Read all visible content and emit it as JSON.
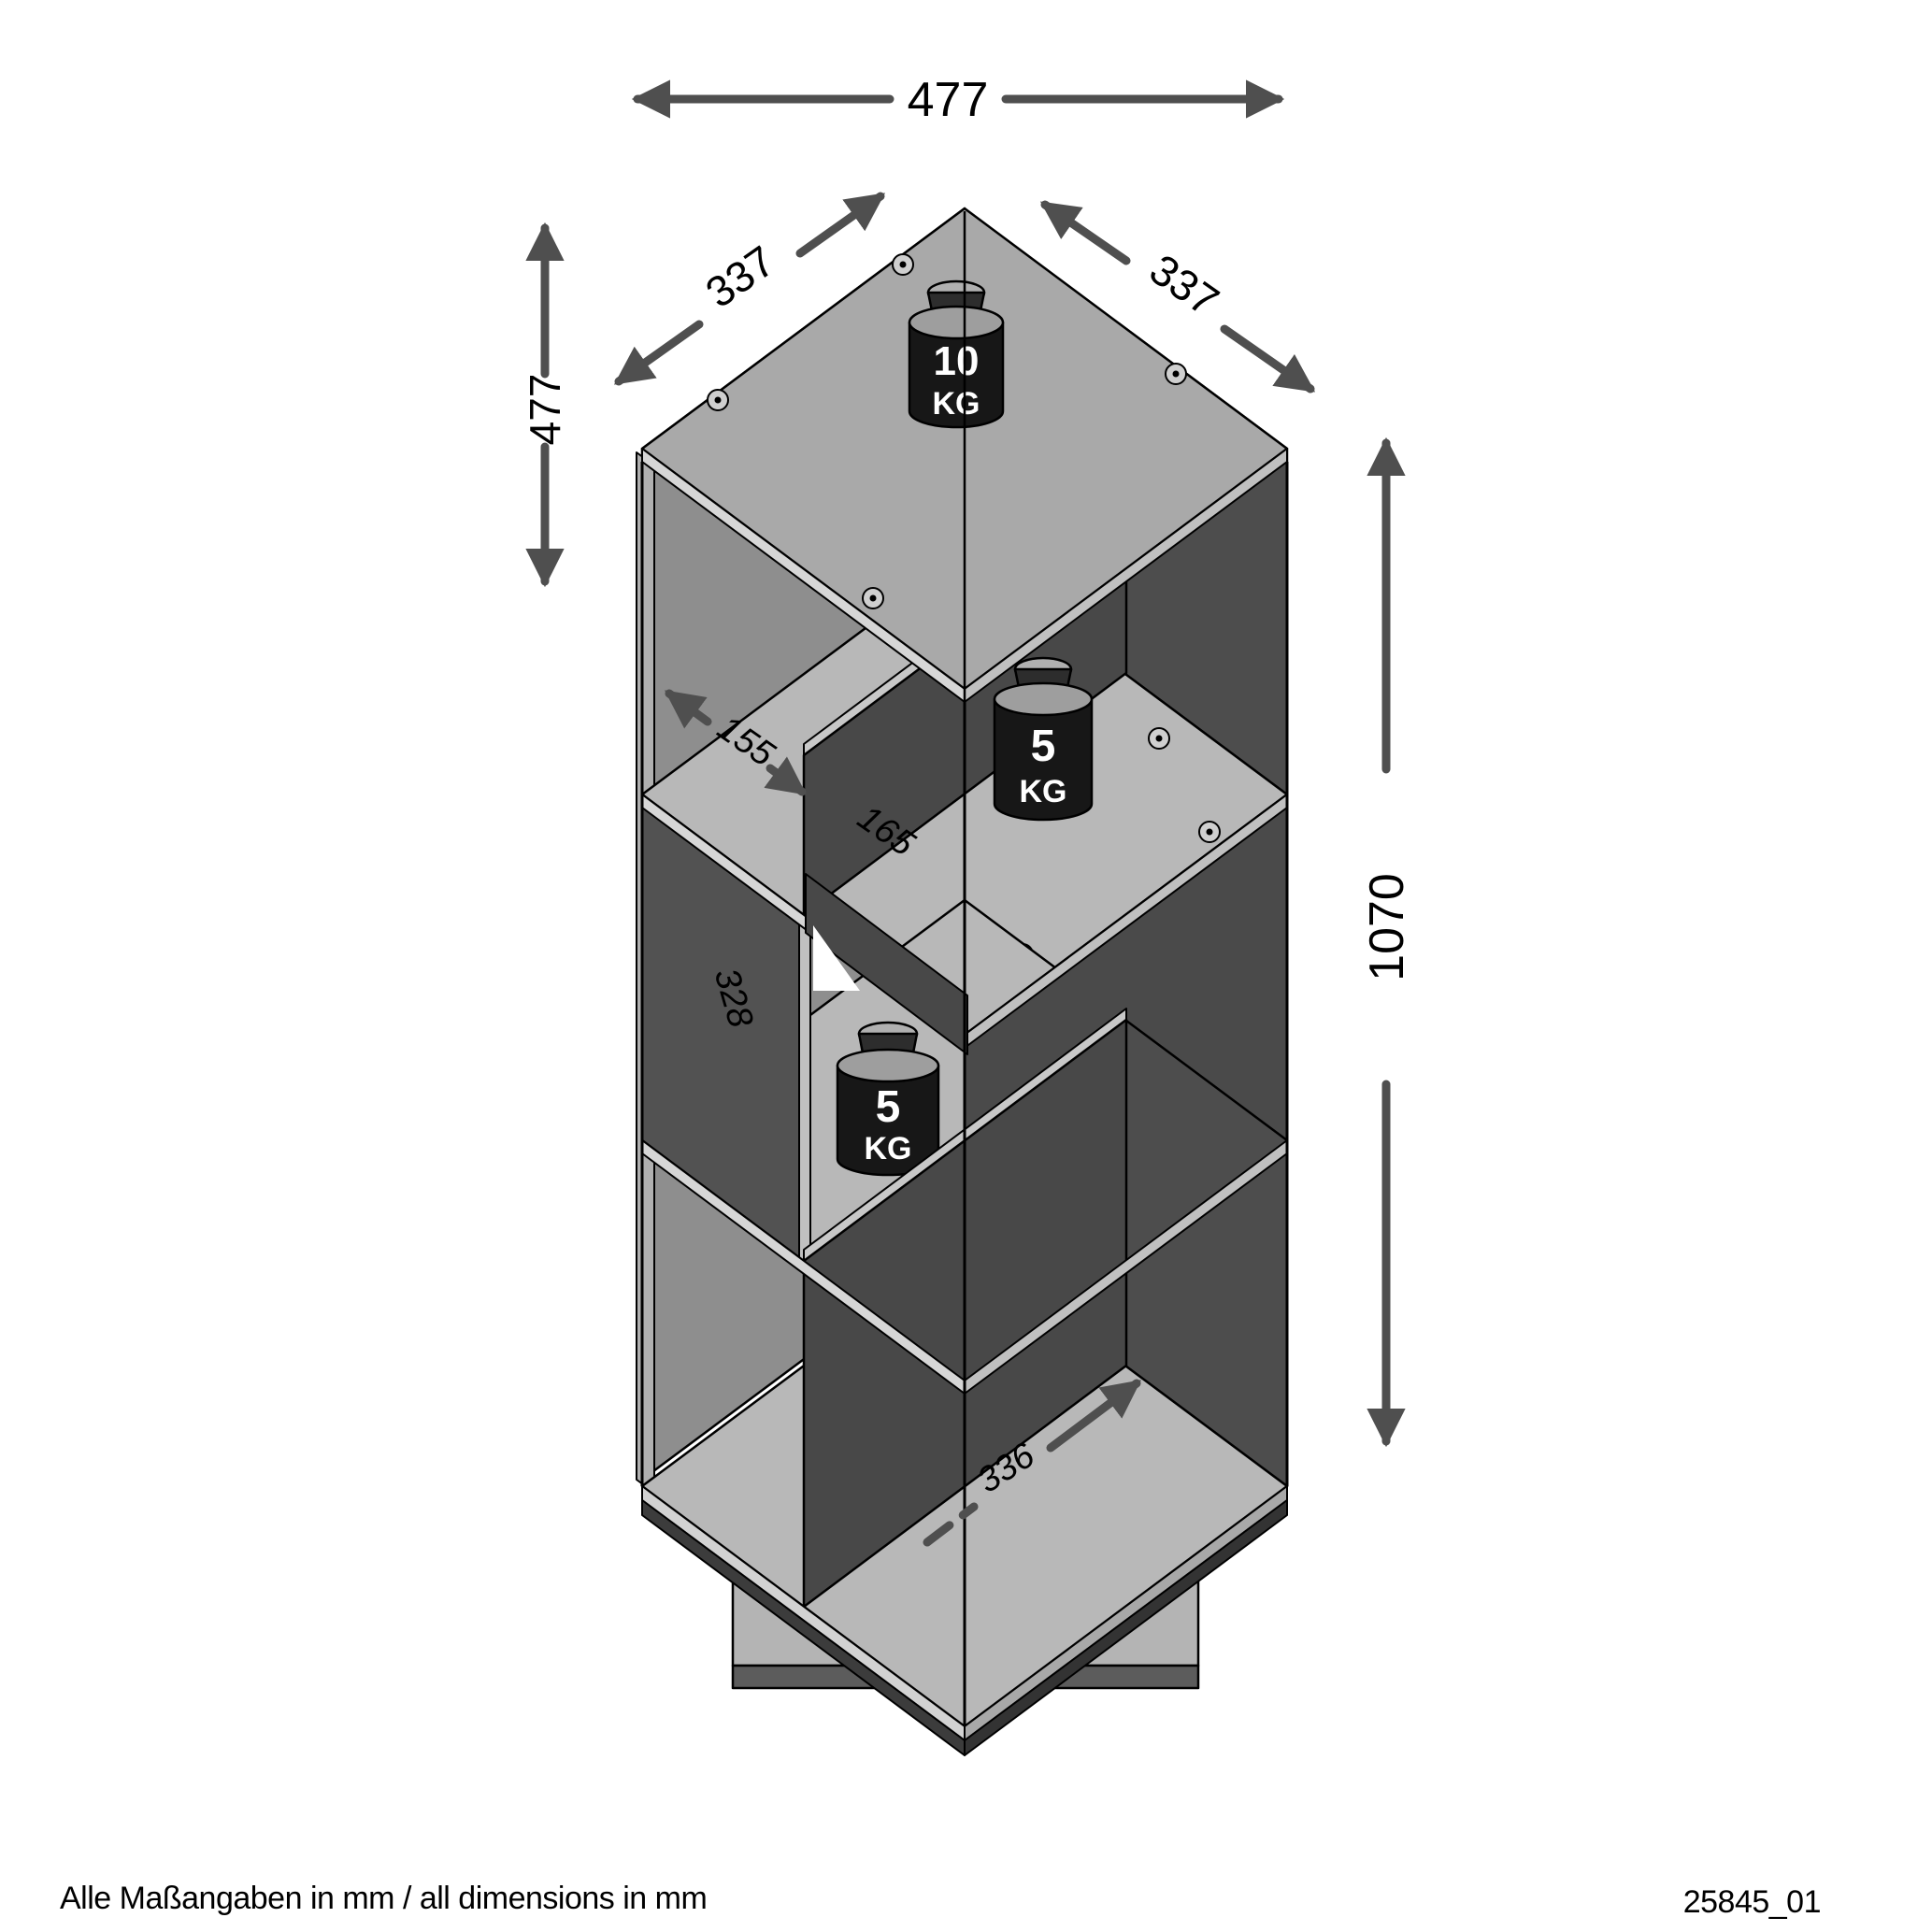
{
  "drawing": {
    "footer_note": "Alle Maßangaben in mm / all dimensions in mm",
    "drawing_number": "25845_01"
  },
  "dimensions_mm": {
    "overall_width": "477",
    "top_depth_left": "337",
    "top_depth_right": "337",
    "upper_section_height": "477",
    "overall_height": "1070",
    "compartment_width": "155",
    "divider_height": "165",
    "middle_panel_height": "328",
    "bottom_compartment_depth": "336"
  },
  "load_capacity": {
    "top_panel": {
      "value": "10",
      "unit": "KG"
    },
    "upper_shelf": {
      "value": "5",
      "unit": "KG"
    },
    "middle_shelf": {
      "value": "5",
      "unit": "KG"
    }
  },
  "style": {
    "background": "#ffffff",
    "line_color": "#000000",
    "dimension_color": "#4f4f4f",
    "panel_light": "#b8b8b8",
    "panel_mid": "#8e8e8e",
    "panel_dark": "#4a4a4a",
    "weight_color": "#171717"
  }
}
